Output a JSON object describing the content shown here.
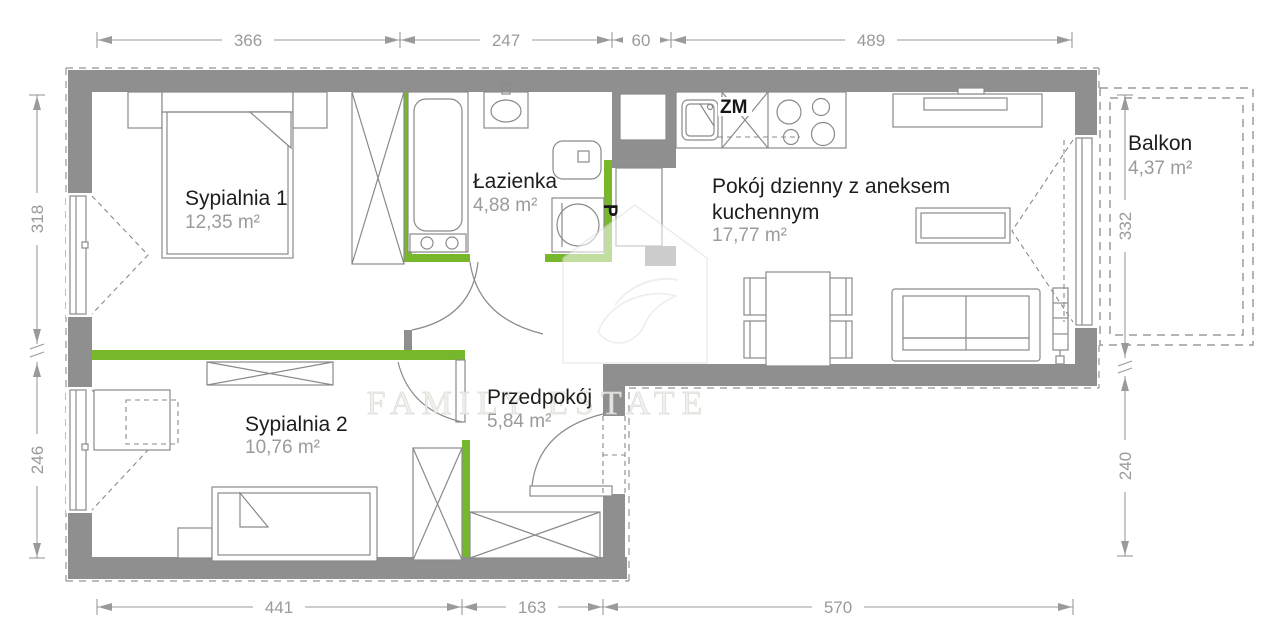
{
  "rooms": {
    "bedroom1": {
      "name": "Sypialnia 1",
      "area": "12,35 m²"
    },
    "bathroom": {
      "name": "Łazienka",
      "area": "4,88 m²"
    },
    "living": {
      "line1": "Pokój dzienny z aneksem",
      "line2": "kuchennym",
      "area": "17,77 m²"
    },
    "bedroom2": {
      "name": "Sypialnia 2",
      "area": "10,76 m²"
    },
    "hall": {
      "name": "Przedpokój",
      "area": "5,84 m²"
    },
    "balcony": {
      "name": "Balkon",
      "area": "4,37 m²"
    }
  },
  "appliances": {
    "dishwasher": "ZM",
    "washing_machine": "P"
  },
  "dimensions": {
    "top": [
      "366",
      "247",
      "60",
      "489"
    ],
    "bottom": [
      "441",
      "163",
      "570"
    ],
    "left": [
      "318",
      "246"
    ],
    "right": [
      "332",
      "240"
    ]
  },
  "watermark": {
    "text": "FAMILY ESTATE"
  },
  "colors": {
    "wall": "#8f8f8f",
    "accent_green": "#77b72c",
    "dimension": "#9a9a9a",
    "room_name": "#1d1d1b",
    "room_area": "#9b9b9b"
  }
}
